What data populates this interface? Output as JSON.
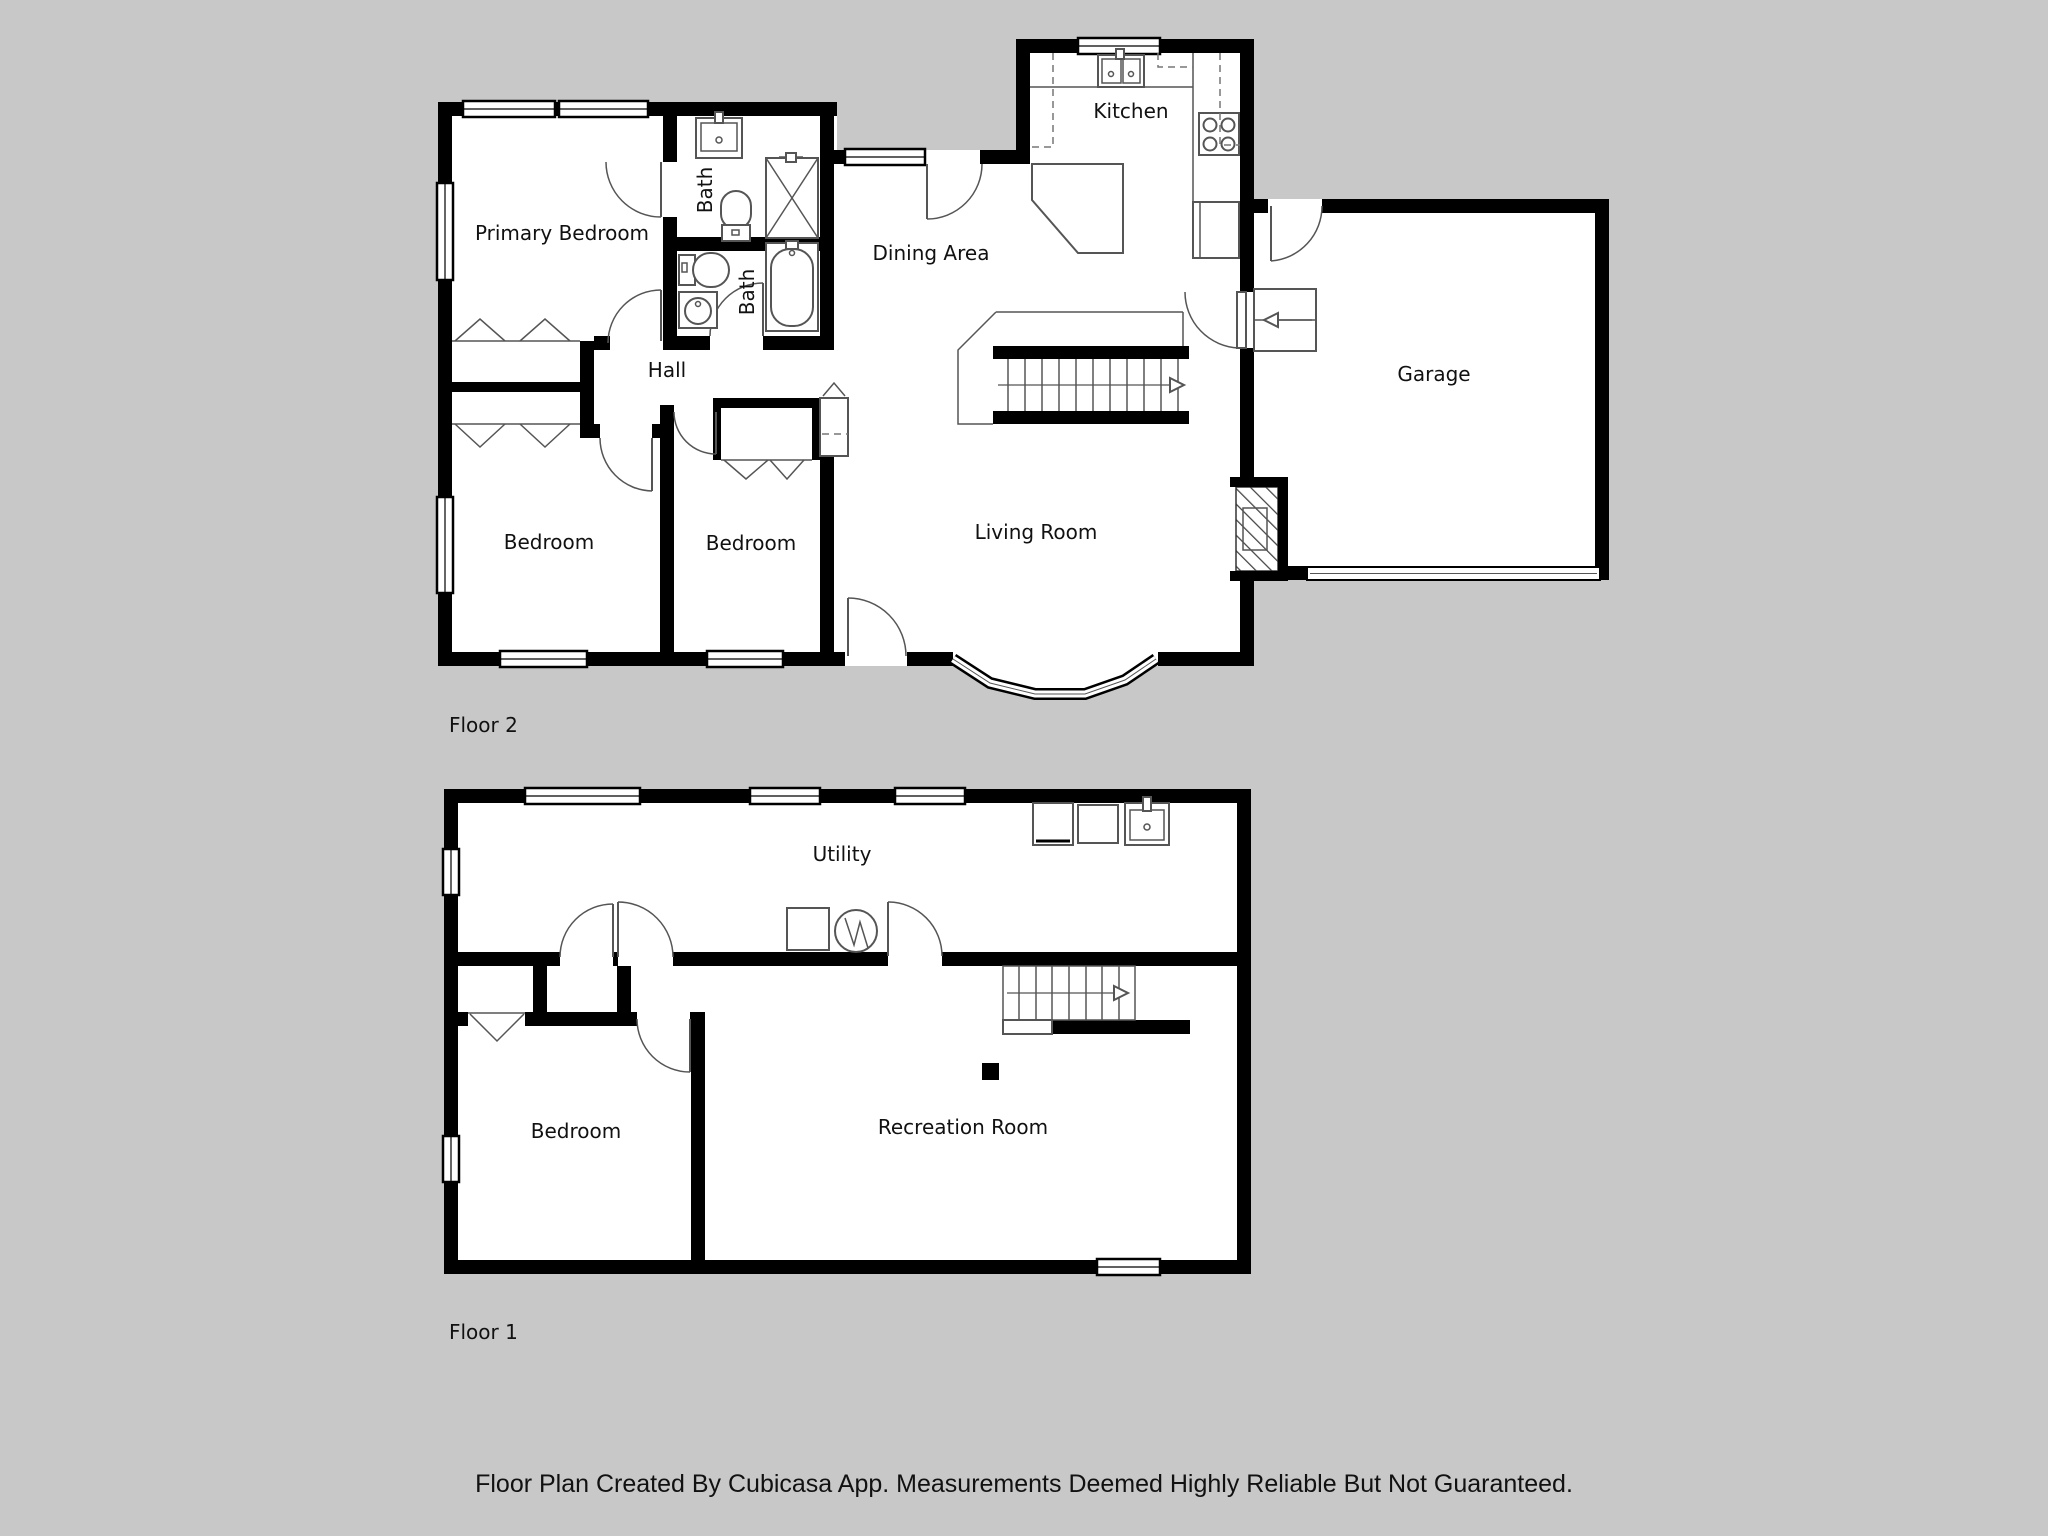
{
  "colors": {
    "background": "#c8c8c8",
    "wall": "#000000",
    "fixture_line": "#555555",
    "room_fill": "#ffffff",
    "label_text": "#111111"
  },
  "caption": "Floor Plan Created By Cubicasa App. Measurements Deemed Highly Reliable But Not Guaranteed.",
  "floor2": {
    "label": "Floor 2",
    "rooms": {
      "primary_bedroom": "Primary Bedroom",
      "bath_upper": "Bath",
      "bath_lower": "Bath",
      "hall": "Hall",
      "bedroom_left": "Bedroom",
      "bedroom_middle": "Bedroom",
      "kitchen": "Kitchen",
      "dining_area": "Dining Area",
      "living_room": "Living Room",
      "garage": "Garage"
    }
  },
  "floor1": {
    "label": "Floor 1",
    "rooms": {
      "utility": "Utility",
      "bedroom": "Bedroom",
      "recreation_room": "Recreation Room"
    }
  }
}
